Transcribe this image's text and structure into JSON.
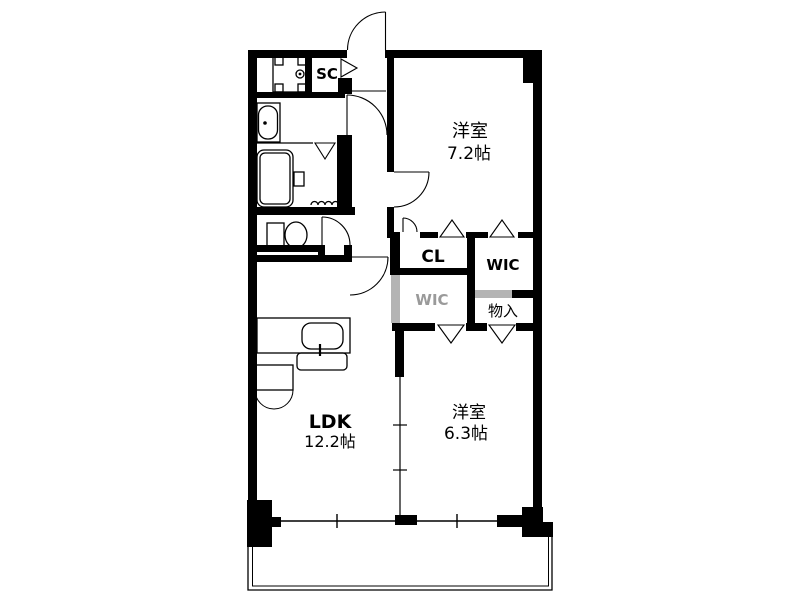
{
  "labels": {
    "sc": "SC",
    "bedroom1_name": "洋室",
    "bedroom1_size": "7.2帖",
    "cl": "CL",
    "wic_upper": "WIC",
    "wic_lower": "WIC",
    "storage": "物入",
    "ldk_name": "LDK",
    "ldk_size": "12.2帖",
    "bedroom2_name": "洋室",
    "bedroom2_size": "6.3帖"
  },
  "colors": {
    "wall": "#000000",
    "background": "#ffffff",
    "watermark_wall": "#b4b4b4",
    "watermark_text": "#9a9a9a"
  },
  "icons": [
    "entrance-door-icon",
    "shoe-closet-folding-door-icon",
    "washer-pan-icon",
    "washbasin-icon",
    "bathtub-icon",
    "bath-folding-door-icon",
    "toilet-icon",
    "kitchen-counter-icon",
    "kitchen-sink-icon",
    "double-door-cabinet-icon",
    "closet-folding-door-icon",
    "hinged-door-icon",
    "sliding-window-icon",
    "partition-line-icon",
    "balcony-rail-icon"
  ]
}
